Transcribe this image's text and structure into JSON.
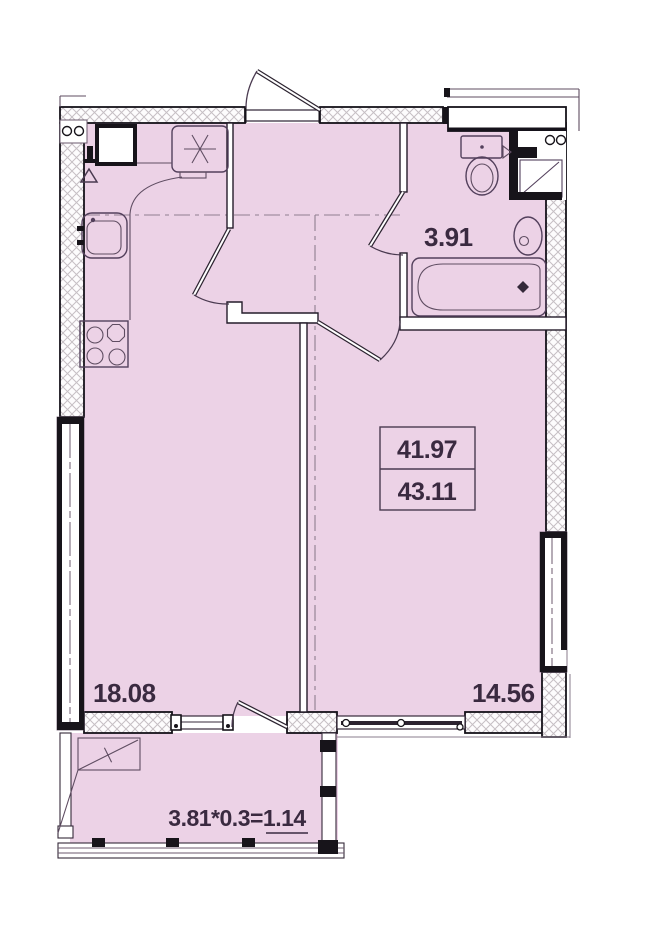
{
  "title": "Apartment floor plan",
  "rooms": {
    "kitchen_living": {
      "area": "18.08"
    },
    "bedroom": {
      "area": "14.56"
    },
    "bathroom": {
      "area": "3.91"
    },
    "balcony": {
      "area_formula": "3.81*0.3=1.14"
    }
  },
  "area_summary": {
    "living_area": "41.97",
    "total_area": "43.11"
  },
  "colors": {
    "floor": "#ecd2e6",
    "wall_outline": "#15121a",
    "fixture_line": "#53405c",
    "label_text": "#3a2a40"
  }
}
